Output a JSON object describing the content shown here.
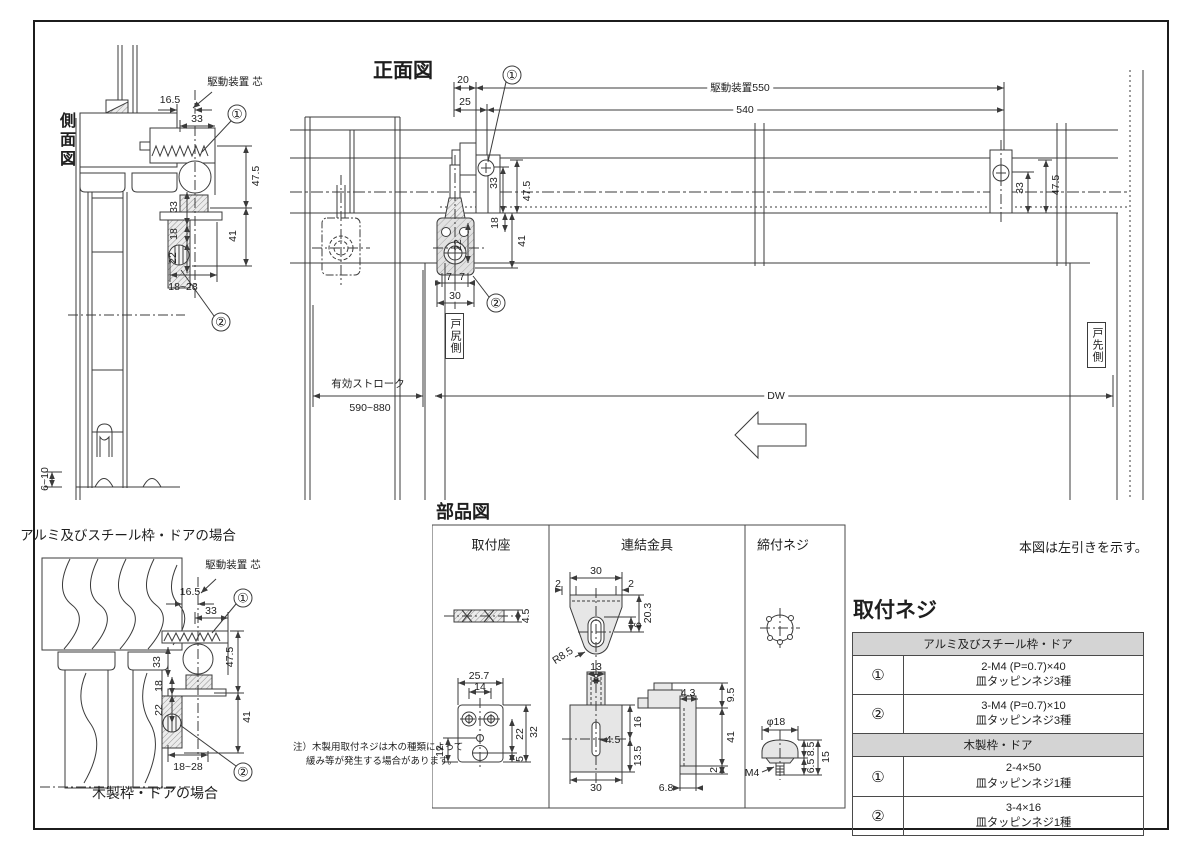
{
  "page": {
    "left_note": "本図は左引きを示す。",
    "note_line1": "注）木製用取付ネジは木の種類によって",
    "note_line2": "緩み等が発生する場合があります。"
  },
  "side_view": {
    "title": "側面図",
    "caption": "アルミ及びスチール枠・ドアの場合",
    "drive_axis_label": "駆動装置 芯",
    "callout_1": "①",
    "callout_2": "②",
    "dims": {
      "w165": "16.5",
      "w33": "33",
      "h475": "47.5",
      "h41": "41",
      "h33": "33",
      "h18": "18",
      "h22": "22",
      "w1828": "18~28",
      "h610": "6~10"
    }
  },
  "wood_view": {
    "caption": "木製枠・ドアの場合",
    "drive_axis_label": "駆動装置 芯",
    "callout_1": "①",
    "callout_2": "②",
    "dims": {
      "w165": "16.5",
      "w33": "33",
      "h475": "47.5",
      "h41": "41",
      "h33": "33",
      "h18": "18",
      "h22": "22",
      "w1828": "18~28"
    }
  },
  "front_view": {
    "title": "正面図",
    "callout_1": "①",
    "callout_2": "②",
    "door_tail_label": "戸尻側",
    "door_front_label": "戸先側",
    "dims": {
      "w20": "20",
      "w25": "25",
      "drive550": "駆動装置550",
      "w540": "540",
      "h475_left": "47.5",
      "h33_left": "33",
      "h18": "18",
      "h22": "22",
      "h41": "41",
      "w7a": "7",
      "w7b": "7",
      "w30": "30",
      "h33_right": "33",
      "h475_right": "47.5",
      "stroke_label": "有効ストローク",
      "stroke_value": "590~880",
      "dw": "DW"
    }
  },
  "parts": {
    "title": "部品図",
    "panel_1": {
      "title": "取付座",
      "dims": {
        "t45": "4.5",
        "w257": "25.7",
        "w14": "14",
        "h22": "22",
        "h32": "32",
        "h12": "12",
        "h5": "5"
      }
    },
    "panel_2": {
      "title": "連結金具",
      "dims": {
        "w30t": "30",
        "w2l": "2",
        "w2r": "2",
        "h203": "20.3",
        "h6": "6",
        "r85": "R8.5",
        "w13": "13",
        "w8": "8",
        "d45": "4.5",
        "h16": "16",
        "h135": "13.5",
        "w30b": "30",
        "w43": "4.3",
        "h95": "9.5",
        "h41": "41",
        "h2": "2",
        "w68": "6.8"
      }
    },
    "panel_3": {
      "title": "締付ネジ",
      "dims": {
        "d18": "φ18",
        "h85": "8.5",
        "h15": "15",
        "h65": "6.5",
        "m4": "M4"
      }
    }
  },
  "screw_table": {
    "title": "取付ネジ",
    "sections": [
      {
        "header": "アルミ及びスチール枠・ドア",
        "rows": [
          {
            "no": "①",
            "spec": "2-M4 (P=0.7)×40",
            "type": "皿タッピンネジ3種"
          },
          {
            "no": "②",
            "spec": "3-M4 (P=0.7)×10",
            "type": "皿タッピンネジ3種"
          }
        ]
      },
      {
        "header": "木製枠・ドア",
        "rows": [
          {
            "no": "①",
            "spec": "2-4×50",
            "type": "皿タッピンネジ1種"
          },
          {
            "no": "②",
            "spec": "3-4×16",
            "type": "皿タッピンネジ1種"
          }
        ]
      }
    ]
  }
}
